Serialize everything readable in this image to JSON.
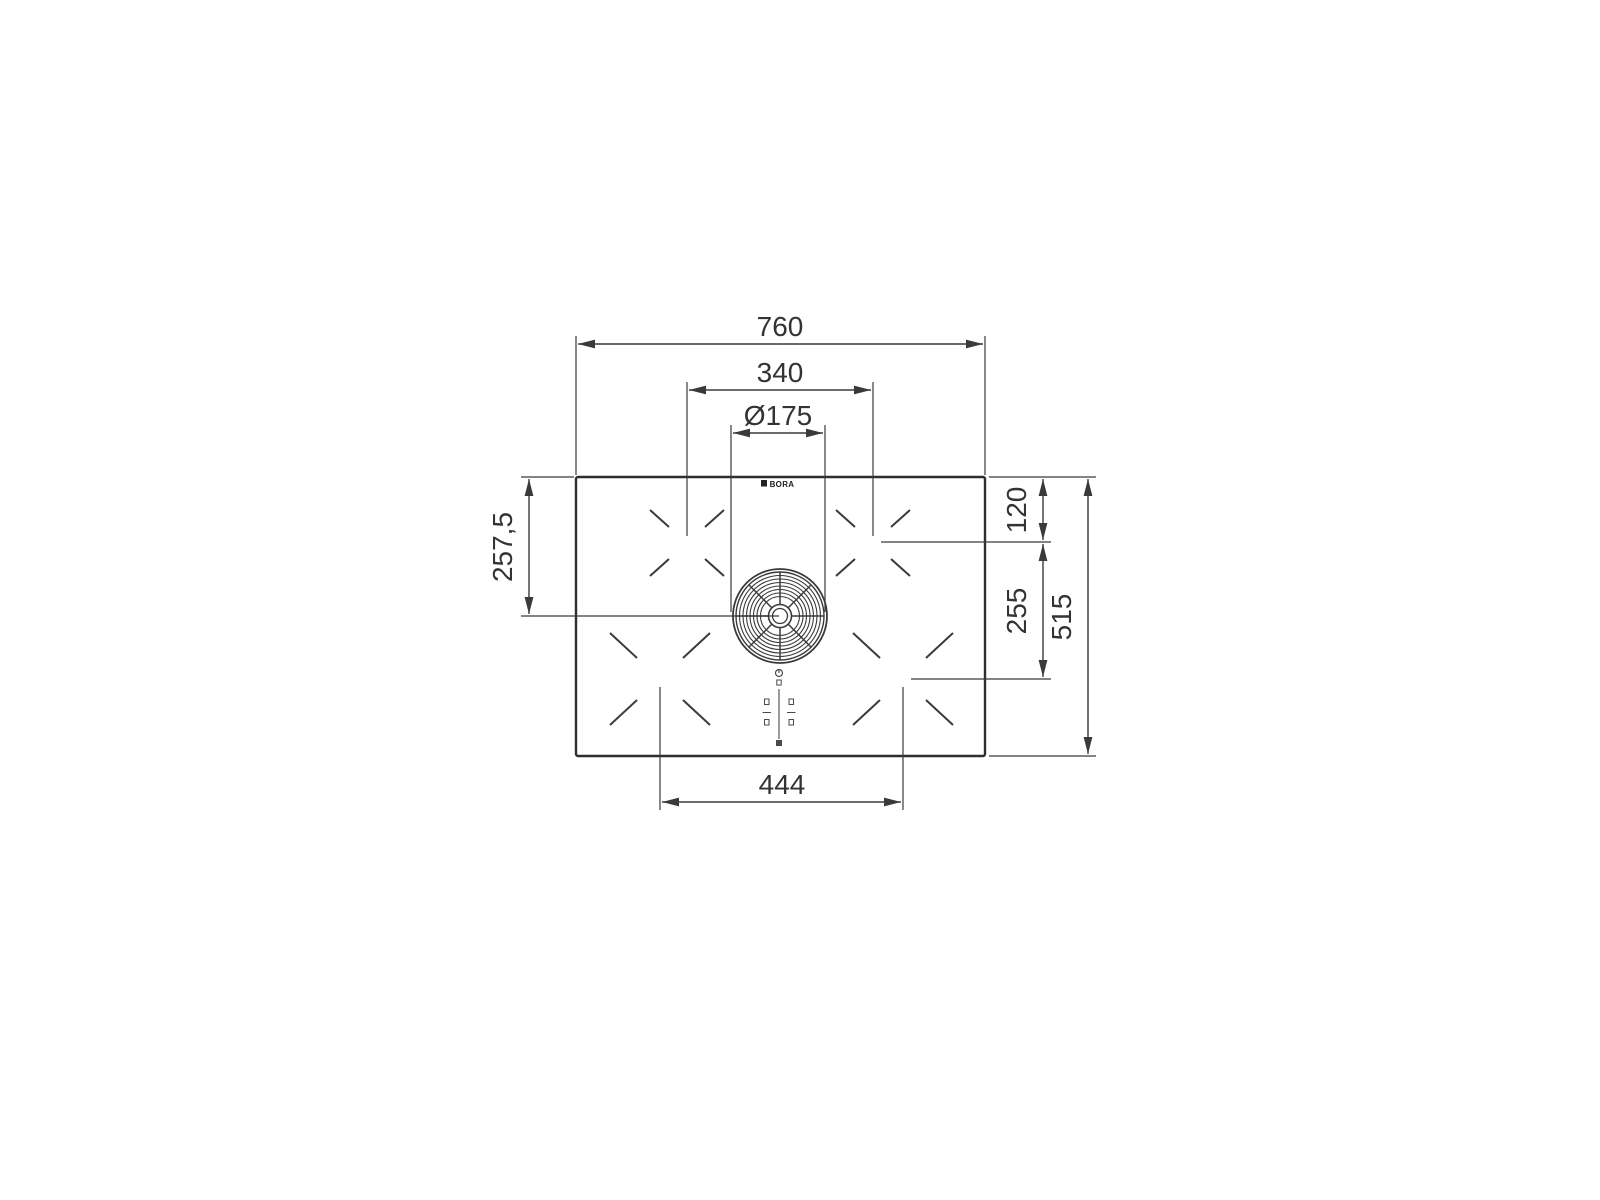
{
  "page": {
    "background": "#ffffff"
  },
  "drawing": {
    "type": "technical-dimension-drawing",
    "subject": "cooktop with integrated central extractor, top view",
    "brand_logo": "BORA",
    "line_color": "#3a3a3a",
    "text_color": "#333333",
    "dimensions": {
      "width_total": "760",
      "top_zone_center_spacing": "340",
      "extractor_diameter": "Ø175",
      "top_edge_to_extractor_center": "257,5",
      "top_edge_to_zone_center": "120",
      "zone_center_vertical_spacing": "255",
      "depth_total": "515",
      "bottom_zone_center_spacing": "444"
    }
  }
}
